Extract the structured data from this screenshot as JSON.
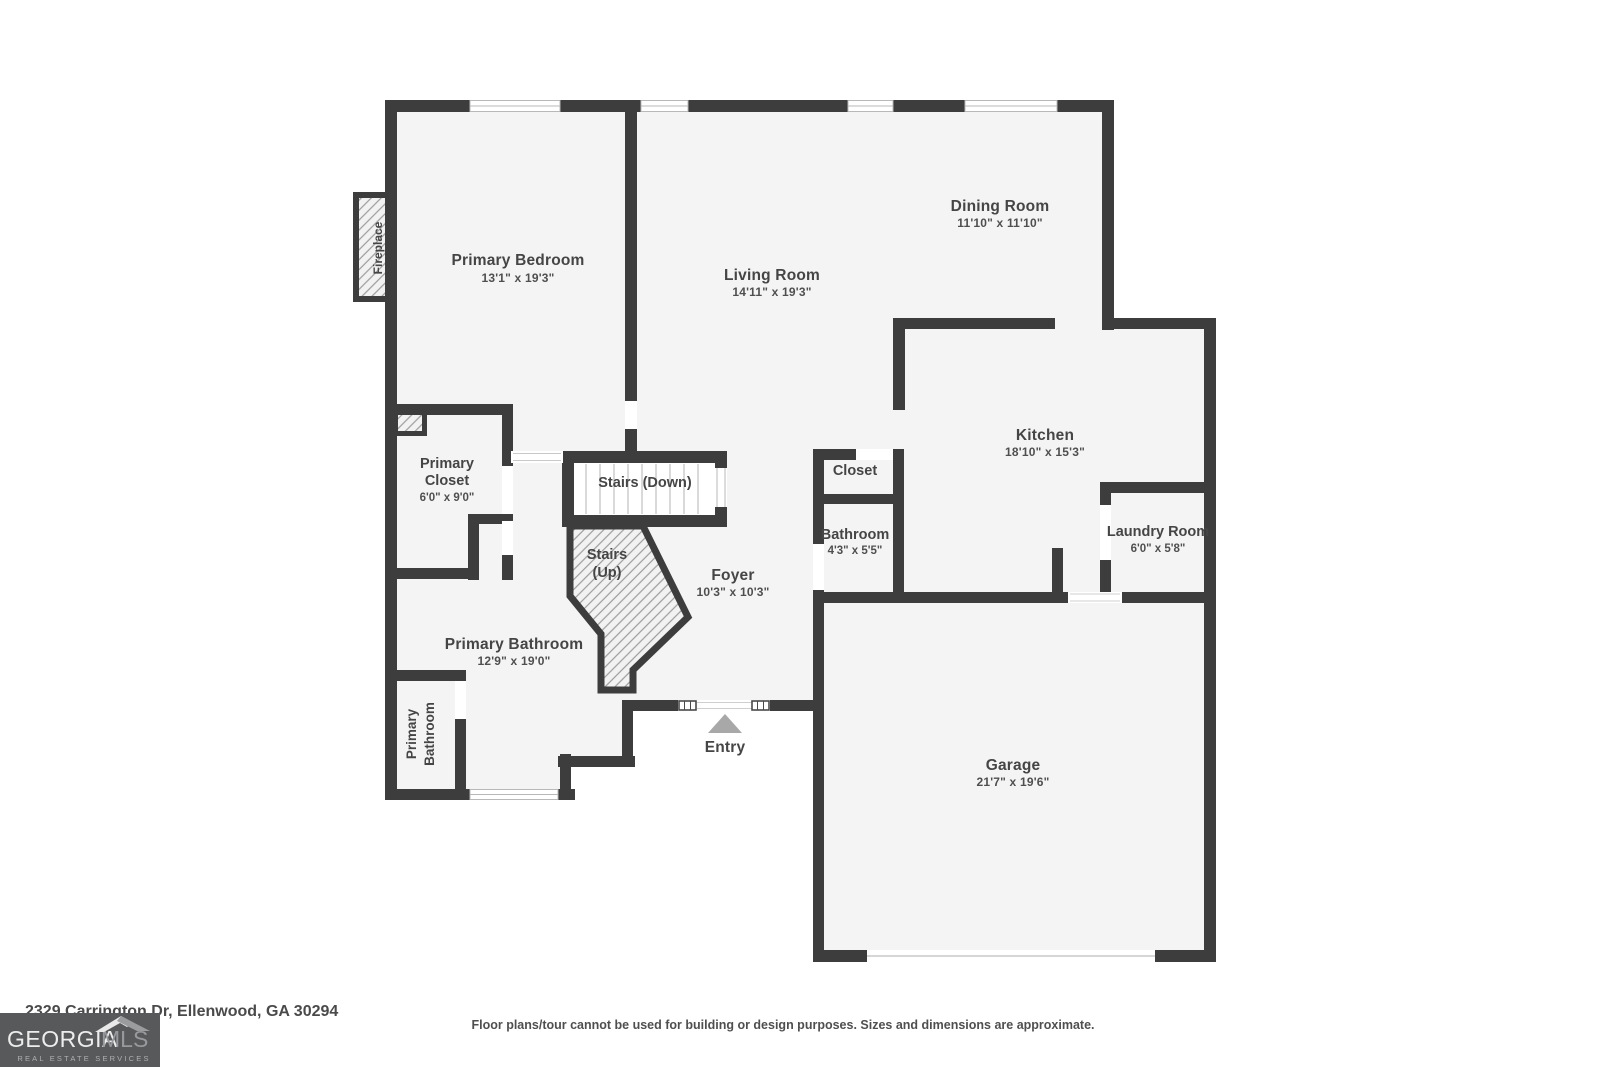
{
  "plan": {
    "primary_bedroom": {
      "name": "Primary Bedroom",
      "dims": "13'1\" x 19'3\""
    },
    "living_room": {
      "name": "Living Room",
      "dims": "14'11\" x 19'3\""
    },
    "dining_room": {
      "name": "Dining Room",
      "dims": "11'10\" x 11'10\""
    },
    "kitchen": {
      "name": "Kitchen",
      "dims": "18'10\" x 15'3\""
    },
    "laundry_room": {
      "name": "Laundry Room",
      "dims": "6'0\" x 5'8\""
    },
    "closet": {
      "name": "Closet"
    },
    "bathroom": {
      "name": "Bathroom",
      "dims": "4'3\" x 5'5\""
    },
    "foyer": {
      "name": "Foyer",
      "dims": "10'3\" x 10'3\""
    },
    "stairs_down": {
      "name": "Stairs (Down)"
    },
    "stairs_up": {
      "line1": "Stairs",
      "line2": "(Up)"
    },
    "primary_closet": {
      "line1": "Primary",
      "line2": "Closet",
      "dims": "6'0\" x 9'0\""
    },
    "primary_bathroom": {
      "name": "Primary Bathroom",
      "dims": "12'9\" x 19'0\""
    },
    "primary_bathroom_wc": {
      "line1": "Primary",
      "line2": "Bathroom"
    },
    "garage": {
      "name": "Garage",
      "dims": "21'7\" x 19'6\""
    },
    "entry": {
      "label": "Entry"
    },
    "fireplace": {
      "label": "Fireplace"
    }
  },
  "footer": {
    "address": "2329 Carrington Dr, Ellenwood, GA 30294",
    "disclaimer": "Floor plans/tour cannot be used for building or design purposes. Sizes and dimensions are approximate."
  },
  "logo": {
    "brand_primary": "GEORGIA",
    "brand_secondary": "MLS",
    "tagline": "REAL ESTATE SERVICES"
  },
  "icons": {
    "entry_arrow": "triangle-up-icon",
    "logo_house": "roof-icon"
  },
  "colors": {
    "wall": "#3d3d3d",
    "room_fill": "#f4f4f4",
    "opening_white": "#ffffff",
    "label_text": "#454545",
    "entry_arrow": "#a8a8a8",
    "logo_background": "#58595b",
    "hatch_line": "#9c9c9c",
    "stair_tread": "#c9c9c9"
  }
}
